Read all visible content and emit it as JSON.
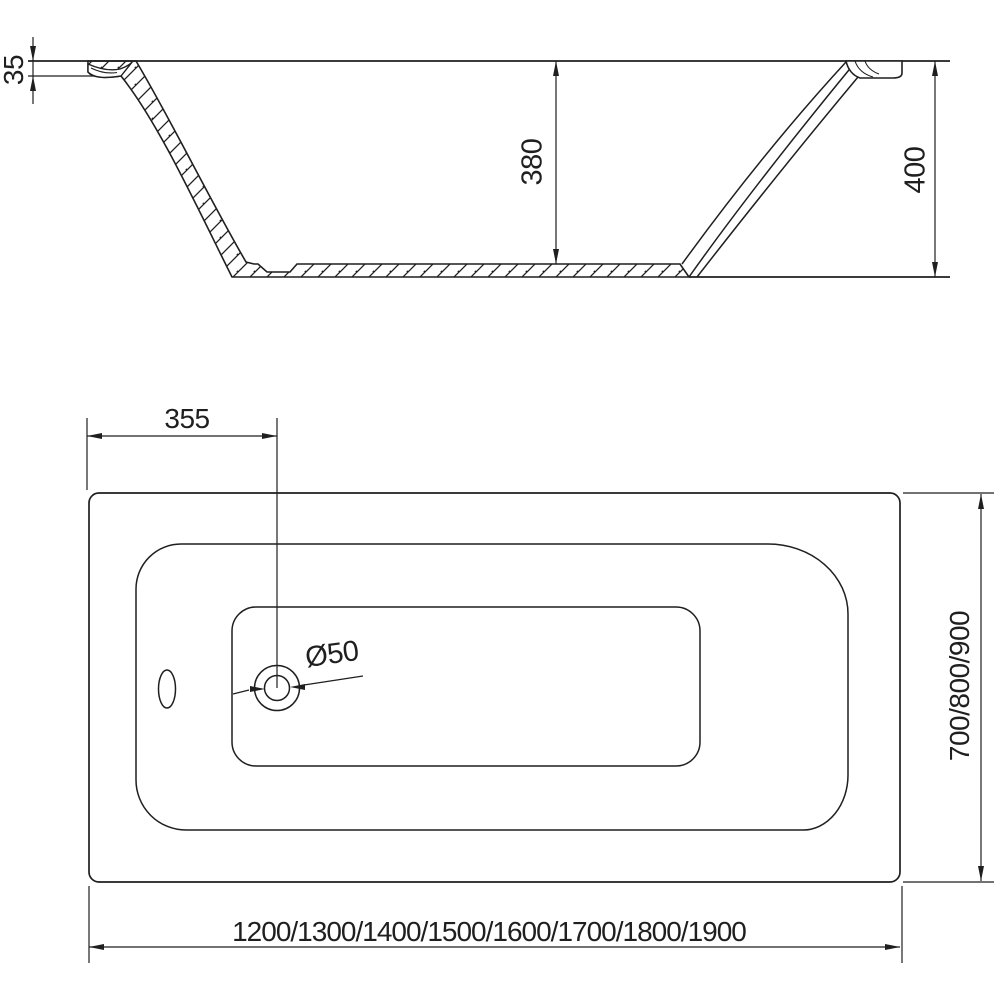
{
  "drawing": {
    "type": "bathtub-technical-drawing",
    "background_color": "#ffffff",
    "line_color": "#1f1f1f",
    "section_view": {
      "rim_drop_label": "35",
      "inner_depth_label": "380",
      "total_height_label": "400"
    },
    "plan_view": {
      "drain_offset_label": "355",
      "drain_diameter_label": "Ø50",
      "width_options_label": "700/800/900",
      "length_options_label": "1200/1300/1400/1500/1600/1700/1800/1900"
    }
  }
}
